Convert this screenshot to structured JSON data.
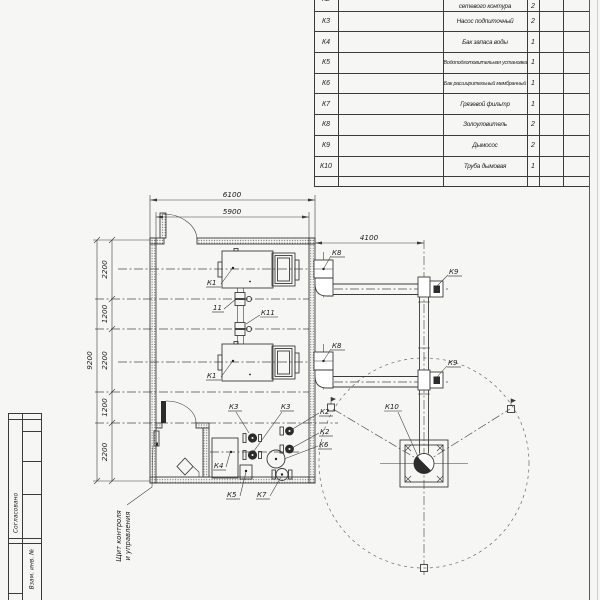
{
  "colors": {
    "background": "#f6f6f4",
    "line": "#3b3b3b",
    "frame": "#5a5a5a"
  },
  "spec_table": {
    "rows": [
      {
        "pos": "К2",
        "name": "сетевого контура",
        "qty": "2"
      },
      {
        "pos": "К3",
        "name": "Насос подпиточный",
        "qty": "2"
      },
      {
        "pos": "К4",
        "name": "Бак запаса воды",
        "qty": "1"
      },
      {
        "pos": "К5",
        "name": "Водоподготовительная установка",
        "qty": "1"
      },
      {
        "pos": "К6",
        "name": "Бак расширительный мембранный",
        "qty": "1"
      },
      {
        "pos": "К7",
        "name": "Грязевой фильтр",
        "qty": "1"
      },
      {
        "pos": "К8",
        "name": "Золоуловитель",
        "qty": "2"
      },
      {
        "pos": "К9",
        "name": "Дымосос",
        "qty": "2"
      },
      {
        "pos": "К10",
        "name": "Труба дымовая",
        "qty": "1"
      }
    ]
  },
  "dims": {
    "top_outer": "6100",
    "top_inner": "5900",
    "flue_offset": "4100",
    "left_overall": "9200",
    "left_chain": [
      "2200",
      "1200",
      "2200",
      "1200",
      "2200"
    ]
  },
  "plan": {
    "labels": {
      "k1_upper": "К1",
      "k1_lower": "К1",
      "pos11": "11",
      "k11": "К11",
      "k3_a": "К3",
      "k3_b": "К3",
      "k4": "К4",
      "k5": "К5",
      "k7": "К7",
      "k2_a": "К2",
      "k2_b": "К2",
      "k6": "К6",
      "k8_a": "К8",
      "k8_b": "К8",
      "k9_a": "К9",
      "k9_b": "К9",
      "k10": "К10"
    },
    "panel_note": [
      "Щит контроля",
      "и управления"
    ]
  },
  "title_block": {
    "agreed": "Согласовано",
    "replace_inv": "Взам. инв. №"
  }
}
